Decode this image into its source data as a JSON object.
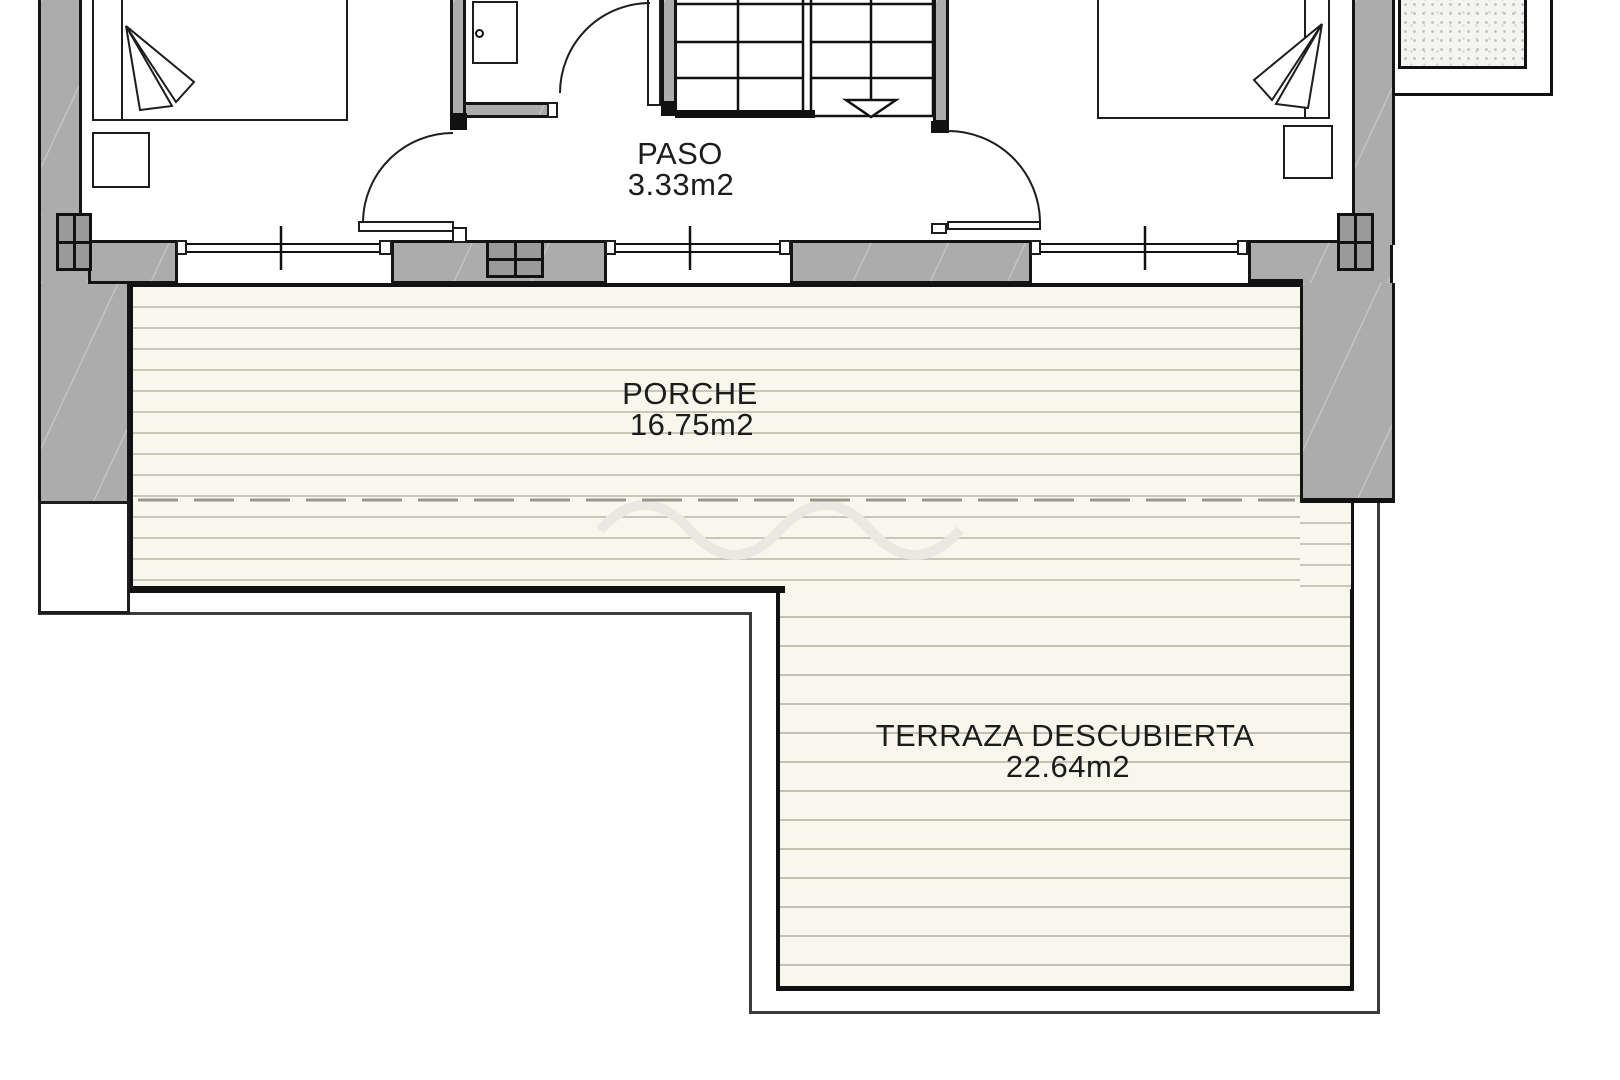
{
  "drawing": {
    "type": "architectural-floor-plan",
    "rooms": [
      {
        "name": "PASO",
        "area": "3.33m2"
      },
      {
        "name": "PORCHE",
        "area": "16.75m2"
      },
      {
        "name": "TERRAZA DESCUBIERTA",
        "area": "22.64m2"
      }
    ],
    "symbols": [
      "double-bed",
      "nightstand",
      "door-swing",
      "staircase-down-arrow",
      "window",
      "structural-column",
      "deck-boards",
      "roof-overhang-dashed-line",
      "gravel-lightwell"
    ],
    "colors": {
      "wall_fill": "#acacac",
      "column_fill": "#9a9a9a",
      "line": "#111111",
      "deck_background": "#f8f7ee",
      "deck_stripe": "#c9c8b6",
      "dashed_overhang": "#98978c",
      "outer_line": "#3c3c3c",
      "text": "#1c1c1c"
    }
  }
}
